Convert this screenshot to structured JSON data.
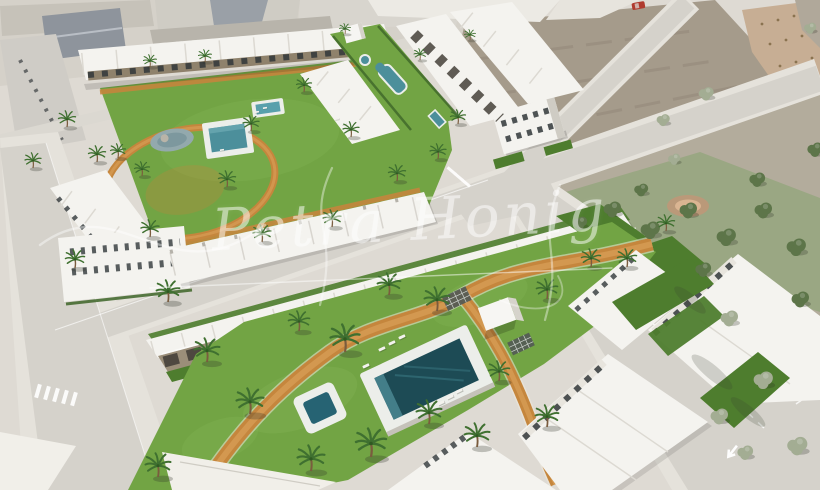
{
  "scene": {
    "type": "aerial-architectural-render",
    "description": "Aerial 3D render of a modern white townhouse development with landscaped courtyards, swimming pools, palm trees and terracotta paths, bordered by roads, vacant plots and a pine park",
    "watermark": {
      "text": "Petra Honig",
      "color": "#ffffff",
      "opacity": 0.52
    }
  },
  "palette": {
    "ground": "#dedad3",
    "road": "#d5d2cb",
    "sidewalk": "#e5e2db",
    "grass": "#72a444",
    "grass_dark": "#4e7d2e",
    "hedge": "#3e6629",
    "pool_deck": "#eceeea",
    "pool_water": "#4c8f9b",
    "pool_deep": "#1d4b55",
    "path": "#c5863d",
    "path_light": "#d49a52",
    "building": "#f4f3ef",
    "building_shade": "#c9c6bd",
    "window": "#32383a",
    "terrace": "#8a7c66",
    "pergola": "#46413a",
    "dirt": "#a59b8b",
    "scrub": "#b3ac9c",
    "olive": "#c7ae94",
    "park": "#9aa783",
    "tree": "#5d7549",
    "tree_pale": "#a3ad93",
    "palm": "#3f7030",
    "trunk": "#7a5c3e",
    "town_roof": "#8e949c",
    "car_red": "#b03a2e"
  },
  "vegetation": {
    "palms": [
      [
        75,
        268,
        0.95
      ],
      [
        67,
        127,
        0.85
      ],
      [
        97,
        162,
        0.85
      ],
      [
        150,
        237,
        0.9
      ],
      [
        227,
        187,
        0.85
      ],
      [
        251,
        131,
        0.8
      ],
      [
        304,
        92,
        0.75
      ],
      [
        351,
        137,
        0.8
      ],
      [
        397,
        181,
        0.85
      ],
      [
        438,
        159,
        0.8
      ],
      [
        205,
        62,
        0.65
      ],
      [
        332,
        227,
        0.9
      ],
      [
        458,
        124,
        0.75
      ],
      [
        150,
        67,
        0.65
      ],
      [
        262,
        242,
        0.9
      ],
      [
        118,
        158,
        0.75
      ],
      [
        142,
        176,
        0.75
      ],
      [
        33,
        168,
        0.8
      ],
      [
        345,
        34,
        0.55
      ],
      [
        420,
        60,
        0.6
      ],
      [
        470,
        40,
        0.55
      ],
      [
        168,
        302,
        1.15
      ],
      [
        207,
        362,
        1.25
      ],
      [
        250,
        414,
        1.35
      ],
      [
        158,
        477,
        1.25
      ],
      [
        299,
        331,
        1.05
      ],
      [
        345,
        352,
        1.45
      ],
      [
        389,
        295,
        1.15
      ],
      [
        437,
        311,
        1.25
      ],
      [
        371,
        457,
        1.5
      ],
      [
        311,
        471,
        1.35
      ],
      [
        429,
        424,
        1.25
      ],
      [
        477,
        447,
        1.25
      ],
      [
        547,
        299,
        1.05
      ],
      [
        591,
        267,
        0.95
      ],
      [
        627,
        267,
        0.95
      ],
      [
        547,
        427,
        1.15
      ],
      [
        499,
        381,
        1.05
      ],
      [
        666,
        231,
        0.85
      ]
    ],
    "trees": [
      {
        "x": 612,
        "y": 212,
        "s": 1.0,
        "tone": "dark"
      },
      {
        "x": 650,
        "y": 233,
        "s": 1.1,
        "tone": "dark"
      },
      {
        "x": 688,
        "y": 213,
        "s": 1.0,
        "tone": "dark"
      },
      {
        "x": 726,
        "y": 240,
        "s": 1.1,
        "tone": "dark"
      },
      {
        "x": 763,
        "y": 213,
        "s": 1.0,
        "tone": "dark"
      },
      {
        "x": 796,
        "y": 250,
        "s": 1.1,
        "tone": "dark"
      },
      {
        "x": 703,
        "y": 272,
        "s": 0.9,
        "tone": "dark"
      },
      {
        "x": 641,
        "y": 192,
        "s": 0.8,
        "tone": "dark"
      },
      {
        "x": 757,
        "y": 182,
        "s": 0.9,
        "tone": "dark"
      },
      {
        "x": 800,
        "y": 302,
        "s": 1.0,
        "tone": "dark"
      },
      {
        "x": 815,
        "y": 152,
        "s": 0.9,
        "tone": "dark"
      },
      {
        "x": 580,
        "y": 225,
        "s": 0.8,
        "tone": "dark"
      },
      {
        "x": 706,
        "y": 96,
        "s": 0.85,
        "tone": "pale"
      },
      {
        "x": 663,
        "y": 122,
        "s": 0.75,
        "tone": "pale"
      },
      {
        "x": 729,
        "y": 321,
        "s": 1.0,
        "tone": "pale"
      },
      {
        "x": 763,
        "y": 383,
        "s": 1.1,
        "tone": "pale"
      },
      {
        "x": 797,
        "y": 449,
        "s": 1.15,
        "tone": "pale"
      },
      {
        "x": 719,
        "y": 419,
        "s": 1.0,
        "tone": "pale"
      },
      {
        "x": 674,
        "y": 161,
        "s": 0.7,
        "tone": "pale"
      },
      {
        "x": 810,
        "y": 30,
        "s": 0.7,
        "tone": "pale"
      },
      {
        "x": 745,
        "y": 455,
        "s": 0.9,
        "tone": "pale"
      }
    ],
    "loungers": [
      [
        382,
        349,
        -25,
        1
      ],
      [
        392,
        343,
        -25,
        1
      ],
      [
        402,
        337,
        -25,
        1
      ],
      [
        441,
        403,
        -25,
        1
      ],
      [
        450,
        397,
        -25,
        1
      ],
      [
        459,
        391,
        -25,
        1
      ],
      [
        366,
        366,
        -25,
        1
      ],
      [
        257,
        112,
        -8,
        0.6
      ],
      [
        265,
        108,
        -8,
        0.6
      ],
      [
        337,
        119,
        -8,
        0.6
      ],
      [
        344,
        124,
        -8,
        0.6
      ],
      [
        222,
        150,
        -8,
        0.6
      ]
    ]
  }
}
